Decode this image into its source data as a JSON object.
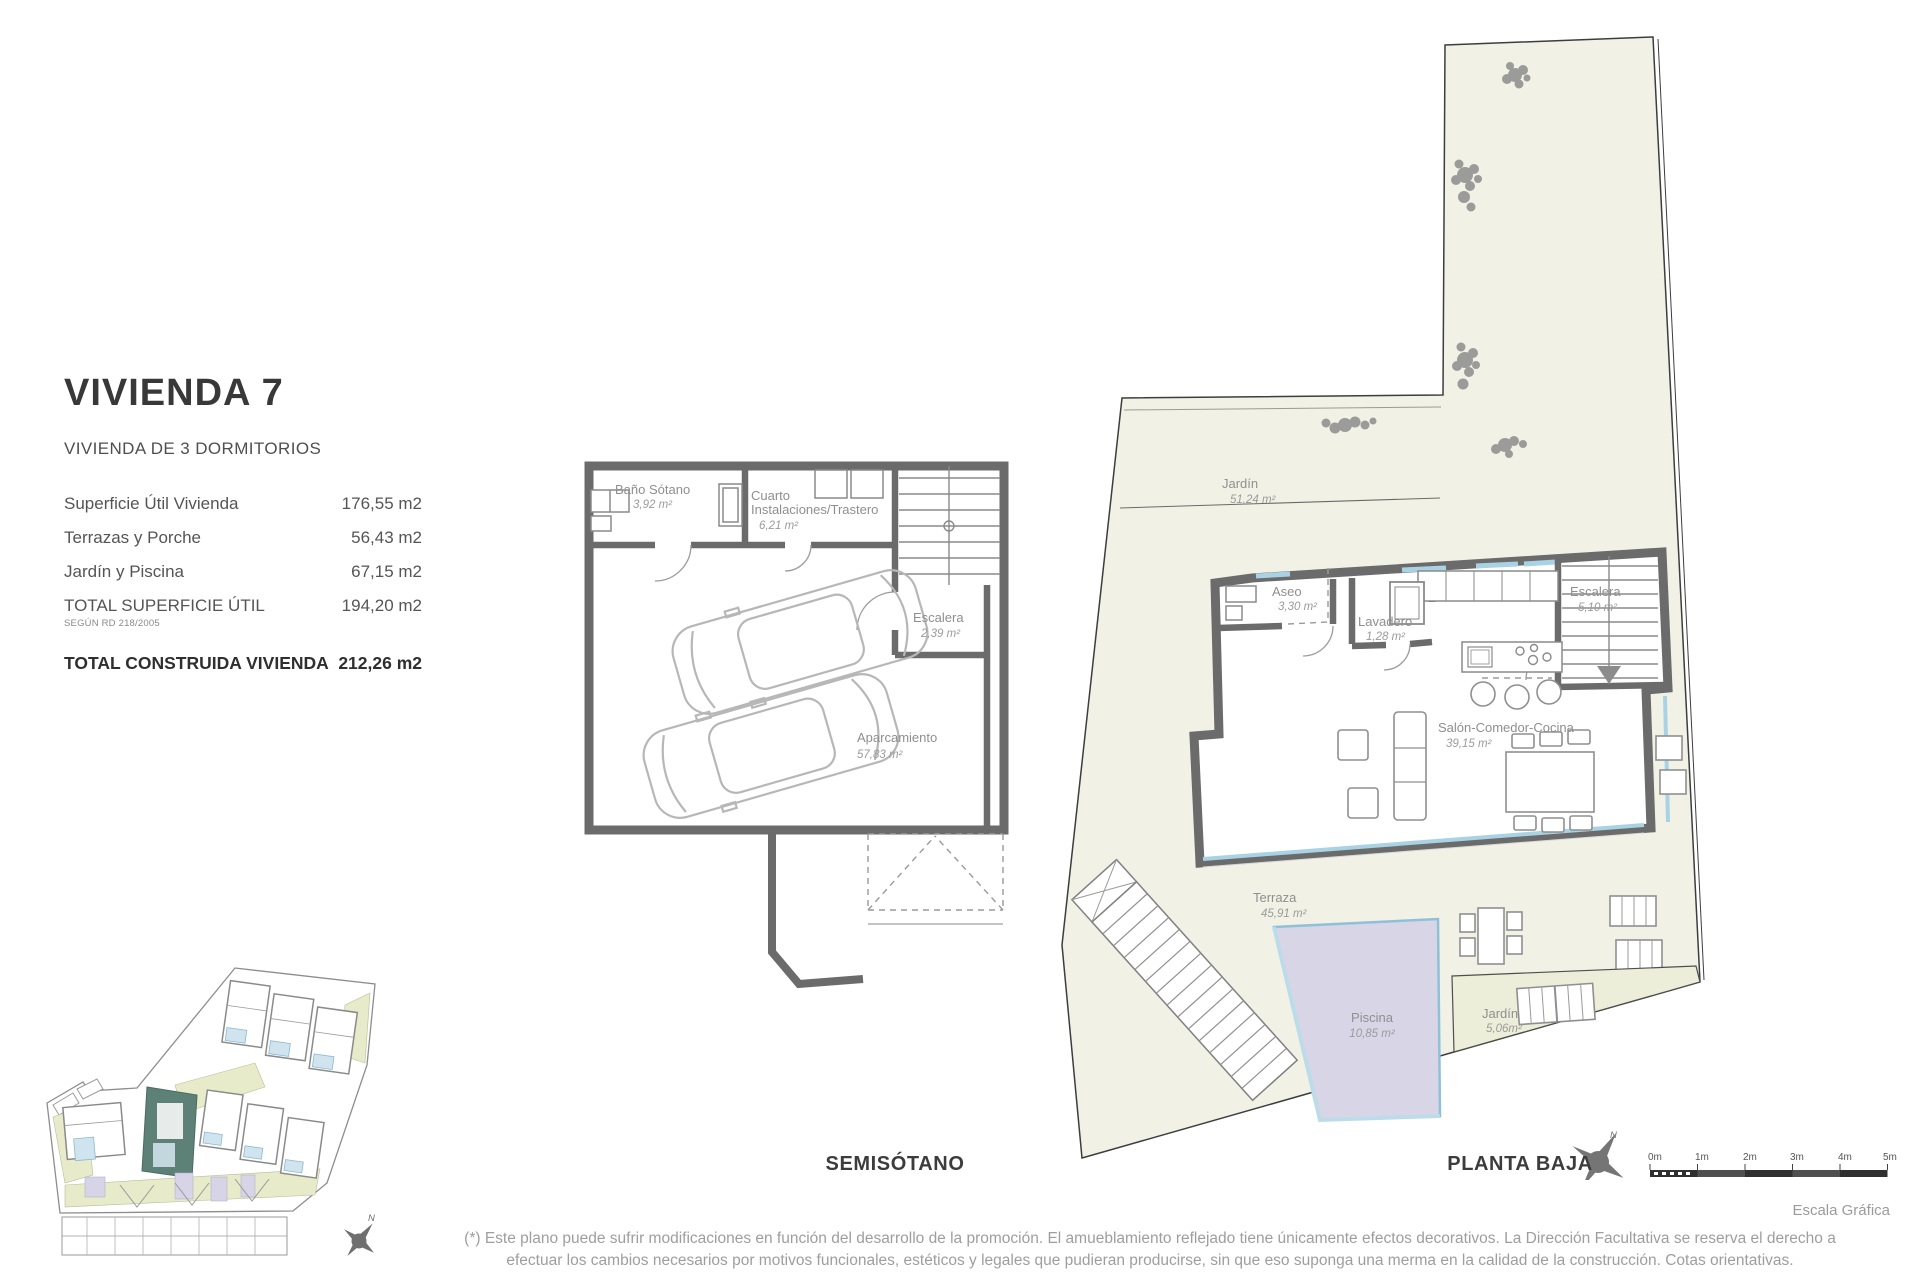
{
  "info": {
    "title": "VIVIENDA 7",
    "subtitle": "VIVIENDA DE 3 DORMITORIOS",
    "rows": [
      {
        "label": "Superficie Útil Vivienda",
        "value": "176,55 m2"
      },
      {
        "label": "Terrazas y Porche",
        "value": "56,43 m2"
      },
      {
        "label": "Jardín y Piscina",
        "value": "67,15 m2"
      },
      {
        "label": "TOTAL SUPERFICIE ÚTIL",
        "note": "SEGÚN RD 218/2005",
        "value": "194,20 m2"
      },
      {
        "label": "TOTAL CONSTRUIDA VIVIENDA",
        "value": "212,26 m2"
      }
    ]
  },
  "basement": {
    "title": "SEMISÓTANO",
    "rooms": {
      "bano": {
        "label": "Baño Sótano",
        "area": "3,92 m²"
      },
      "cuarto": {
        "label_line1": "Cuarto",
        "label_line2": "Instalaciones/Trastero",
        "area": "6,21 m²"
      },
      "escalera": {
        "label": "Escalera",
        "area": "2,39 m²"
      },
      "aparcamiento": {
        "label": "Aparcamiento",
        "area": "57,83 m²"
      }
    }
  },
  "ground": {
    "title": "PLANTA BAJA",
    "rooms": {
      "jardin_norte": {
        "label": "Jardín",
        "area": "51,24 m²"
      },
      "aseo": {
        "label": "Aseo",
        "area": "3,30 m²"
      },
      "lavadero": {
        "label": "Lavadero",
        "area": "1,28 m²"
      },
      "escalera": {
        "label": "Escalera",
        "area": "5,10 m²"
      },
      "salon": {
        "label": "Salón-Comedor-Cocina",
        "area": "39,15 m²"
      },
      "terraza": {
        "label": "Terraza",
        "area": "45,91 m²"
      },
      "piscina": {
        "label": "Piscina",
        "area": "10,85 m²"
      },
      "jardin_sur": {
        "label": "Jardín",
        "area": "5,06m²"
      }
    }
  },
  "compass": {
    "north": "N"
  },
  "scalebar": {
    "ticks": [
      "0m",
      "1m",
      "2m",
      "3m",
      "4m",
      "5m"
    ],
    "caption": "Escala Gráfica"
  },
  "disclaimer": {
    "line1": "(*) Este plano puede sufrir modificaciones en función del desarrollo de la promoción. El amueblamiento reflejado tiene únicamente efectos decorativos. La Dirección Facultativa se reserva el derecho a",
    "line2": "efectuar los cambios necesarios por motivos funcionales, estéticos y legales que pudieran producirse, sin que eso suponga una merma en la calidad de la construcción. Cotas orientativas."
  },
  "colors": {
    "garden": "#f1f2e5",
    "pool": "#d8d5e7",
    "highlight_unit": "#5d8077",
    "wall": "#6b6b6b",
    "window": "#a9d3e5"
  }
}
